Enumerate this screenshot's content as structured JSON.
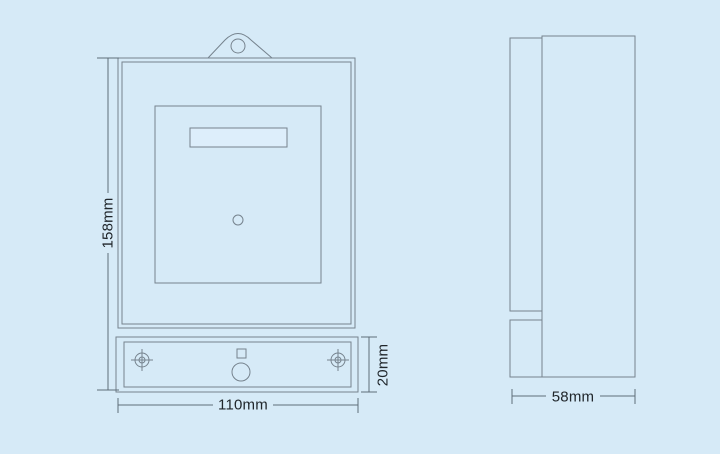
{
  "colors": {
    "background": "#d6eaf7",
    "drawing_line": "#76838e",
    "dimension_line": "#5f6d79",
    "label_text": "#20262b",
    "display_window_fill": "#ddeefb"
  },
  "front_view": {
    "height_label": "158mm",
    "width_label": "110mm",
    "terminal_height_label": "20mm"
  },
  "side_view": {
    "depth_label": "58mm"
  }
}
